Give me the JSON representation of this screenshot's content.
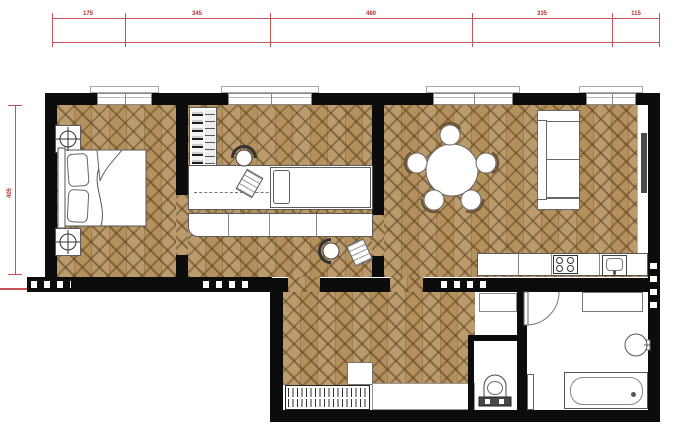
{
  "dimensions": {
    "top": [
      "175",
      "345",
      "480",
      "335",
      "115"
    ],
    "left": "405",
    "color": "#b93030"
  },
  "colors": {
    "wood": "#b3905c",
    "wall": "#0c0c0c",
    "furniture": "#ffffff",
    "dimension_red": "#b93030"
  }
}
